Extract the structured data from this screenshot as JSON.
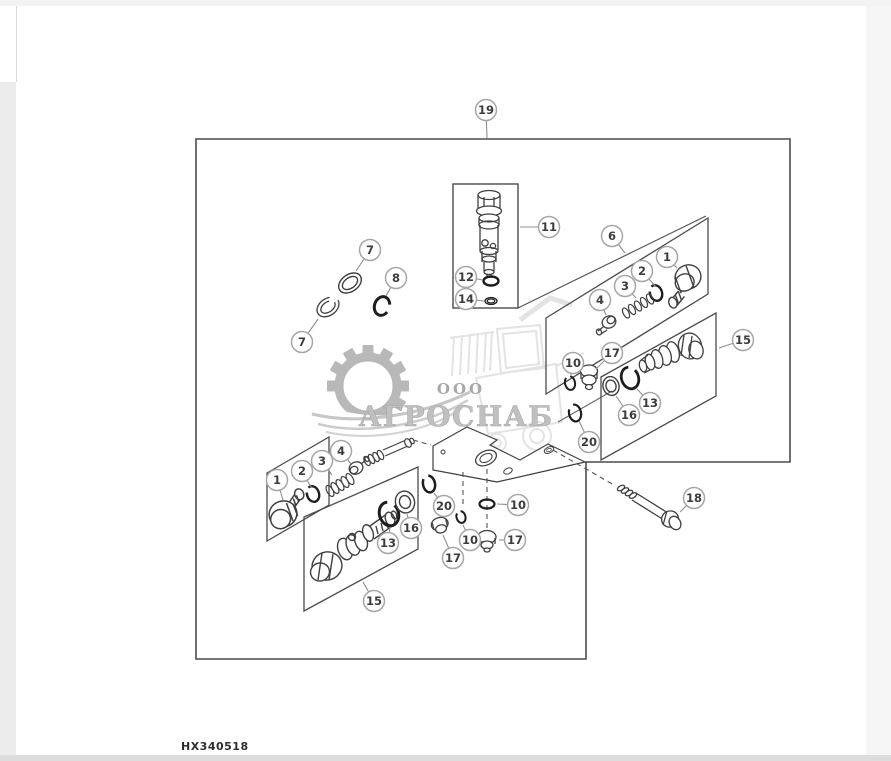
{
  "theme": {
    "paper": "#ffffff",
    "edge_top": "#f3f3f3",
    "edge_left": "#ececec",
    "edge_right": "#f5f5f5",
    "edge_bottom": "#dcdcdc",
    "ink": "#3c3c3c",
    "line": "#4b4b4b",
    "leader": "#8f8f8f",
    "callout_ring": "#a6a6a6",
    "watermark_grey": "#c0c0c0",
    "watermark_dark": "#a8a8a8",
    "watermark_light": "#e3e3e3"
  },
  "watermark": {
    "prefix": "ООО",
    "name": "АГРОСНАБ"
  },
  "footer": {
    "part_code": "HX340518"
  },
  "diagram": {
    "callouts": [
      {
        "label": "19",
        "cx": 486,
        "cy": 110,
        "lx": 487,
        "ly": 138
      },
      {
        "label": "11",
        "cx": 549,
        "cy": 227,
        "lx": 520,
        "ly": 227
      },
      {
        "label": "12",
        "cx": 466,
        "cy": 277,
        "lx": 483,
        "ly": 280
      },
      {
        "label": "14",
        "cx": 466,
        "cy": 299,
        "lx": 484,
        "ly": 301
      },
      {
        "label": "7",
        "cx": 370,
        "cy": 250,
        "lx": 356,
        "ly": 271
      },
      {
        "label": "8",
        "cx": 396,
        "cy": 278,
        "lx": 386,
        "ly": 296
      },
      {
        "label": "7",
        "cx": 302,
        "cy": 342,
        "lx": 318,
        "ly": 319
      },
      {
        "label": "6",
        "cx": 612,
        "cy": 236,
        "lx": 625,
        "ly": 253
      },
      {
        "label": "1",
        "cx": 667,
        "cy": 257,
        "lx": 677,
        "ly": 268
      },
      {
        "label": "2",
        "cx": 642,
        "cy": 271,
        "lx": 656,
        "ly": 287
      },
      {
        "label": "3",
        "cx": 625,
        "cy": 286,
        "lx": 636,
        "ly": 298
      },
      {
        "label": "4",
        "cx": 600,
        "cy": 300,
        "lx": 606,
        "ly": 315
      },
      {
        "label": "15",
        "cx": 743,
        "cy": 340,
        "lx": 719,
        "ly": 348
      },
      {
        "label": "17",
        "cx": 612,
        "cy": 353,
        "lx": 596,
        "ly": 369
      },
      {
        "label": "10",
        "cx": 573,
        "cy": 363,
        "lx": 571,
        "ly": 375
      },
      {
        "label": "13",
        "cx": 650,
        "cy": 403,
        "lx": 637,
        "ly": 389
      },
      {
        "label": "16",
        "cx": 629,
        "cy": 415,
        "lx": 616,
        "ly": 396
      },
      {
        "label": "20",
        "cx": 589,
        "cy": 442,
        "lx": 579,
        "ly": 421
      },
      {
        "label": "18",
        "cx": 694,
        "cy": 498,
        "lx": 680,
        "ly": 512
      },
      {
        "label": "1",
        "cx": 277,
        "cy": 480,
        "lx": 283,
        "ly": 500
      },
      {
        "label": "2",
        "cx": 302,
        "cy": 471,
        "lx": 311,
        "ly": 487
      },
      {
        "label": "3",
        "cx": 322,
        "cy": 461,
        "lx": 332,
        "ly": 475
      },
      {
        "label": "4",
        "cx": 341,
        "cy": 451,
        "lx": 351,
        "ly": 464
      },
      {
        "label": "13",
        "cx": 388,
        "cy": 543,
        "lx": 390,
        "ly": 527
      },
      {
        "label": "16",
        "cx": 411,
        "cy": 528,
        "lx": 407,
        "ly": 514
      },
      {
        "label": "15",
        "cx": 374,
        "cy": 601,
        "lx": 363,
        "ly": 582
      },
      {
        "label": "20",
        "cx": 444,
        "cy": 506,
        "lx": 434,
        "ly": 493
      },
      {
        "label": "17",
        "cx": 453,
        "cy": 558,
        "lx": 443,
        "ly": 535
      },
      {
        "label": "10",
        "cx": 470,
        "cy": 540,
        "lx": 463,
        "ly": 525
      },
      {
        "label": "10",
        "cx": 518,
        "cy": 505,
        "lx": 497,
        "ly": 504
      },
      {
        "label": "17",
        "cx": 515,
        "cy": 540,
        "lx": 499,
        "ly": 540
      }
    ]
  }
}
